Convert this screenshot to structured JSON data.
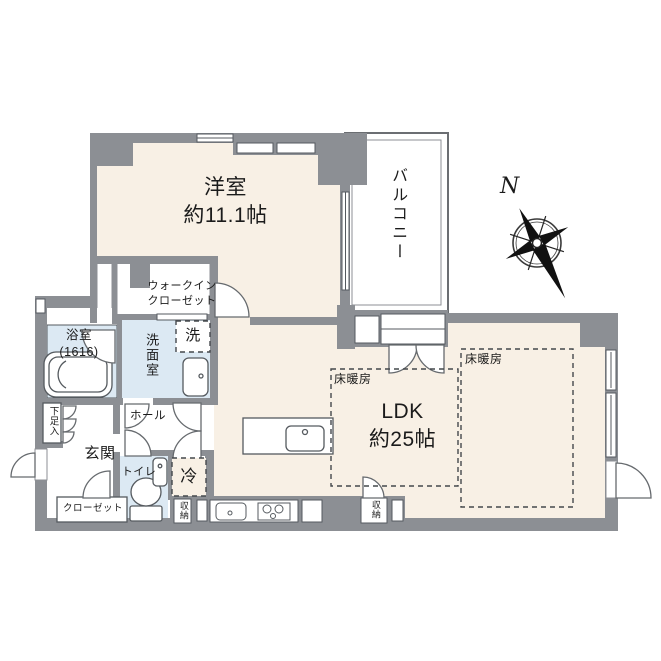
{
  "floor_plan": {
    "labels": {
      "western_room": "洋室\n約11.1帖",
      "balcony": "バルコニー",
      "walk_in_closet": "ウォークイン\nクローゼット",
      "bathroom": "浴室\n(1616)",
      "washroom": "洗面室",
      "washer": "洗",
      "shoe_cabinet": "下足入",
      "hall": "ホール",
      "entrance": "玄関",
      "toilet": "トイレ",
      "closet": "クローゼット",
      "fridge": "冷",
      "storage_left": "収納",
      "storage_right": "収納",
      "ldk": "LDK\n約25帖",
      "floor_heating_left": "床暖房",
      "floor_heating_right": "床暖房",
      "compass_north": "N"
    },
    "colors": {
      "wall": "#8c8f94",
      "room_floor": "#f8f0e5",
      "wet_area_floor": "#dce9f3",
      "line": "#555a5f",
      "text": "#1b1b1b"
    }
  }
}
